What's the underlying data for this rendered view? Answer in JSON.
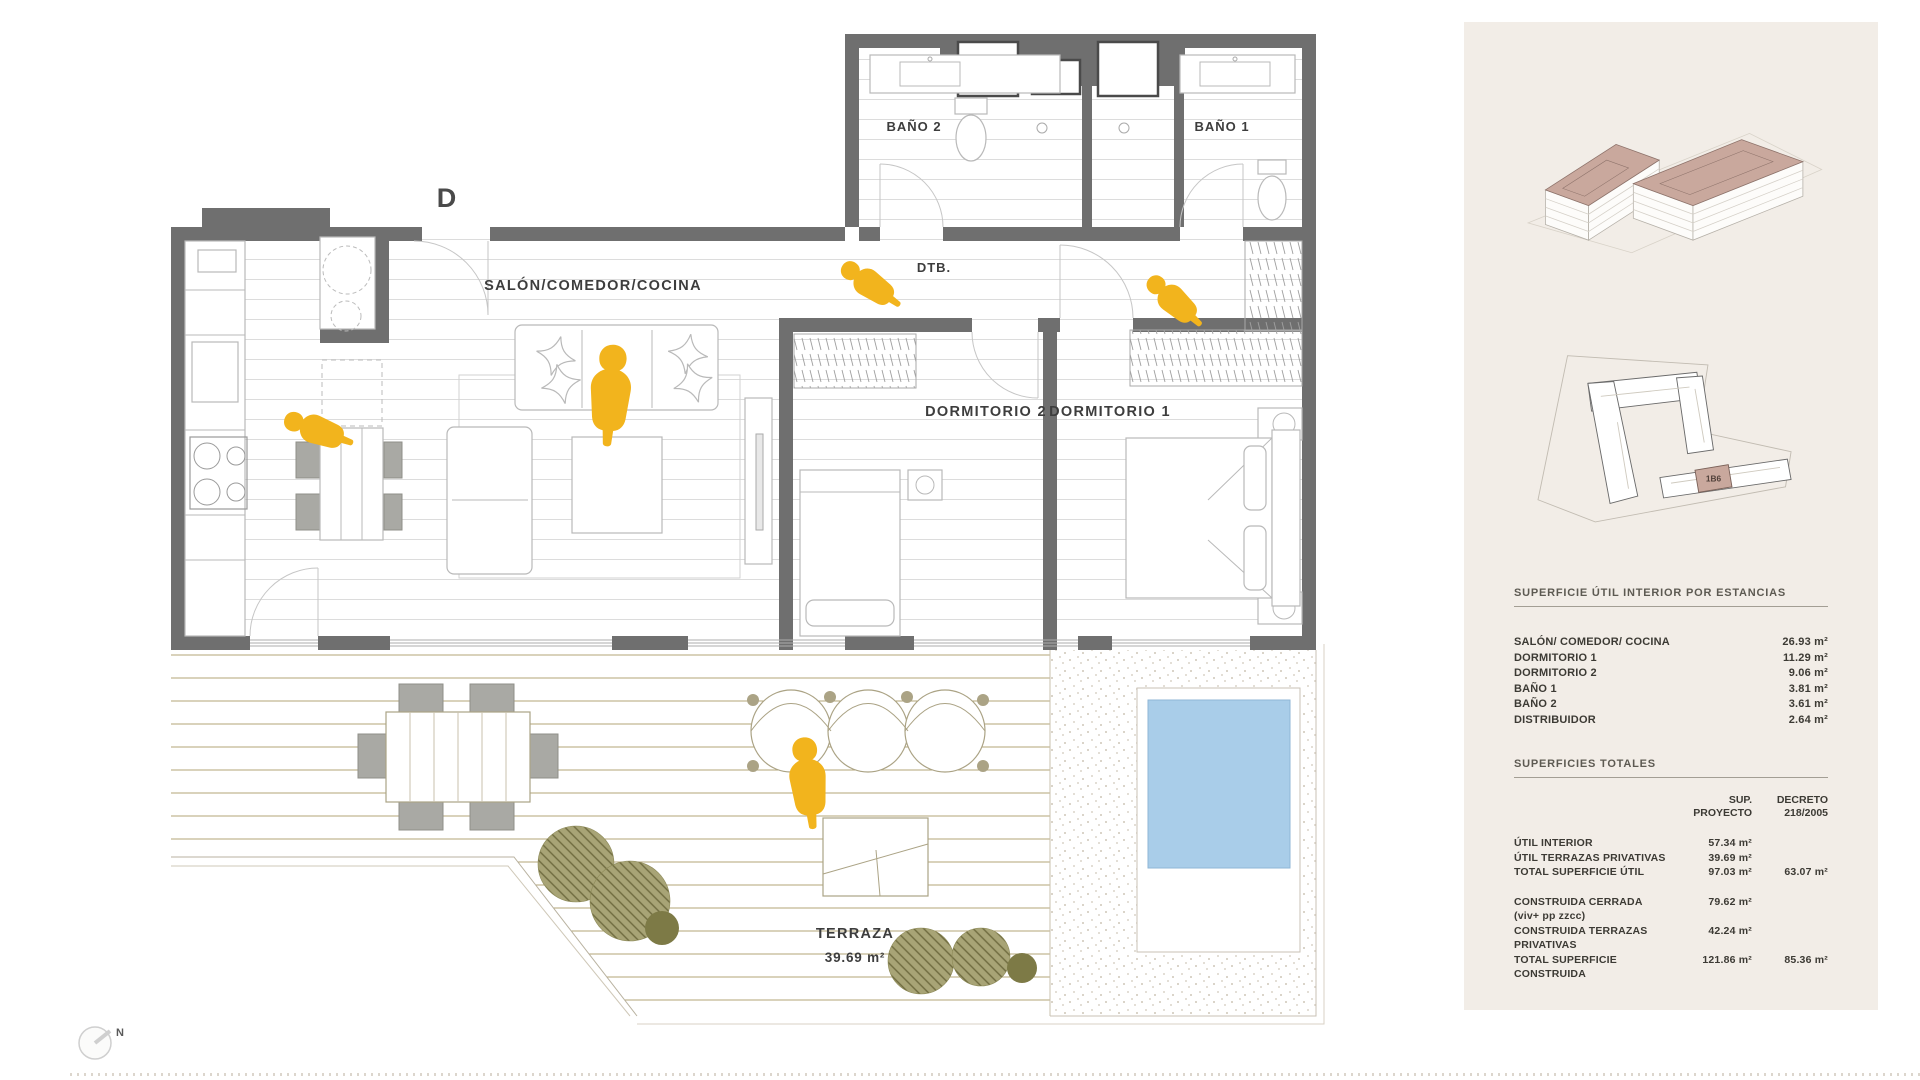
{
  "plan": {
    "entry_label": "D",
    "north_label": "N",
    "rooms": {
      "salon": "SALÓN/COMEDOR/COCINA",
      "bano2": "BAÑO 2",
      "bano1": "BAÑO 1",
      "dtb": "DTB.",
      "dormitorio2": "DORMITORIO 2",
      "dormitorio1": "DORMITORIO 1",
      "terraza": "TERRAZA",
      "terraza_area": "39.69 m²"
    }
  },
  "sidebar": {
    "unit_tag": "1B6",
    "rooms_table": {
      "title": "SUPERFICIE ÚTIL INTERIOR POR ESTANCIAS",
      "rows": [
        {
          "label": "SALÓN/ COMEDOR/ COCINA",
          "value": "26.93 m²"
        },
        {
          "label": "DORMITORIO 1",
          "value": "11.29 m²"
        },
        {
          "label": "DORMITORIO 2",
          "value": "9.06 m²"
        },
        {
          "label": "BAÑO 1",
          "value": "3.81 m²"
        },
        {
          "label": "BAÑO 2",
          "value": "3.61 m²"
        },
        {
          "label": "DISTRIBUIDOR",
          "value": "2.64 m²"
        }
      ]
    },
    "totals_table": {
      "title": "SUPERFICIES TOTALES",
      "columns": {
        "c1l1": "SUP.",
        "c1l2": "PROYECTO",
        "c2l1": "DECRETO",
        "c2l2": "218/2005"
      },
      "rows": [
        {
          "label": "ÚTIL INTERIOR",
          "proyecto": "57.34 m²",
          "decreto": ""
        },
        {
          "label": "ÚTIL TERRAZAS PRIVATIVAS",
          "proyecto": "39.69 m²",
          "decreto": ""
        },
        {
          "label": "TOTAL SUPERFICIE ÚTIL",
          "proyecto": "97.03 m²",
          "decreto": "63.07 m²"
        },
        {
          "label": "CONSTRUIDA CERRADA (viv+ pp zzcc)",
          "proyecto": "79.62 m²",
          "decreto": ""
        },
        {
          "label": "CONSTRUIDA TERRAZAS PRIVATIVAS",
          "proyecto": "42.24 m²",
          "decreto": ""
        },
        {
          "label": "TOTAL SUPERFICIE CONSTRUIDA",
          "proyecto": "121.86 m²",
          "decreto": "85.36 m²"
        }
      ]
    }
  },
  "colors": {
    "accent": "#F2B41D",
    "wall": "#6F6F6F",
    "pool": "#A9CDE9",
    "plant": "#7D7A46",
    "plant_light": "#A8A476",
    "roof": "#C9A89D",
    "sidebar_bg": "#F2EDE7",
    "deck_line": "#B3A577",
    "text": "#3C3A34"
  }
}
